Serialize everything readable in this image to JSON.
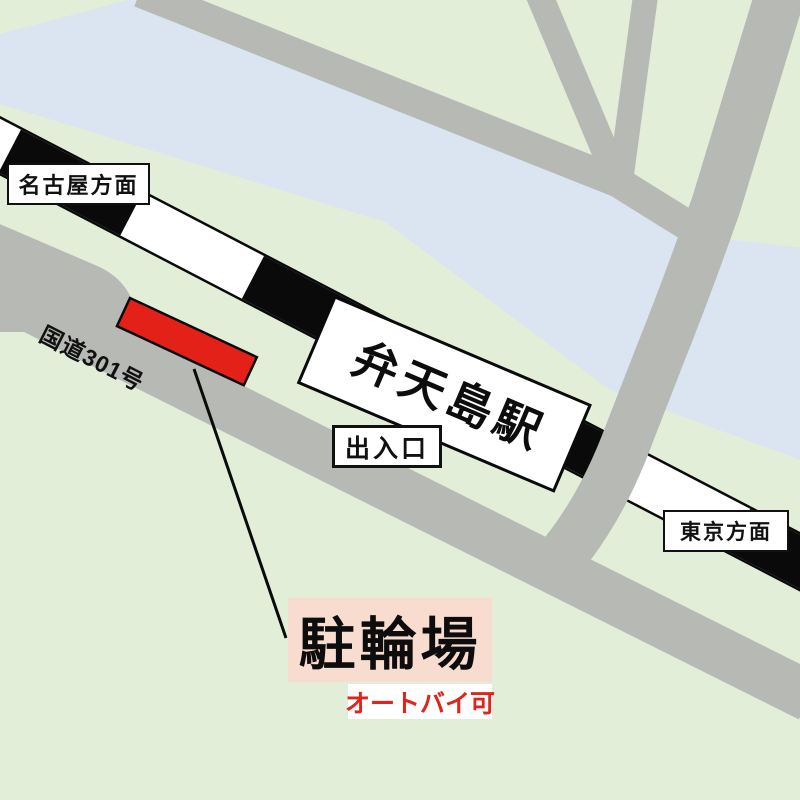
{
  "map": {
    "type": "station-area-guide-map",
    "station_name": "弁天島駅",
    "labels": {
      "nagoya_direction": "名古屋方面",
      "tokyo_direction": "東京方面",
      "exit": "出入口",
      "route_301": "国道301号",
      "parking": "駐輪場",
      "motorcycles_ok": "オートバイ可"
    },
    "features": {
      "railway": "JR line (black/white striped band)",
      "water": "channel along north side",
      "roads": "National Route 301 and side streets",
      "parking_marker": "red rectangle beside Route 301"
    },
    "colors": {
      "land_green": "#e3eed8",
      "water_blue": "#dbe5f1",
      "road_gray": "#b7b9b4",
      "rail_black": "#0a0a0a",
      "rail_white": "#ffffff",
      "parking_red": "#e32119",
      "parking_label_bg": "#f8dccf",
      "moto_text_red": "#e0231b",
      "label_bg": "#ffffff",
      "outline_black": "#111111"
    }
  }
}
